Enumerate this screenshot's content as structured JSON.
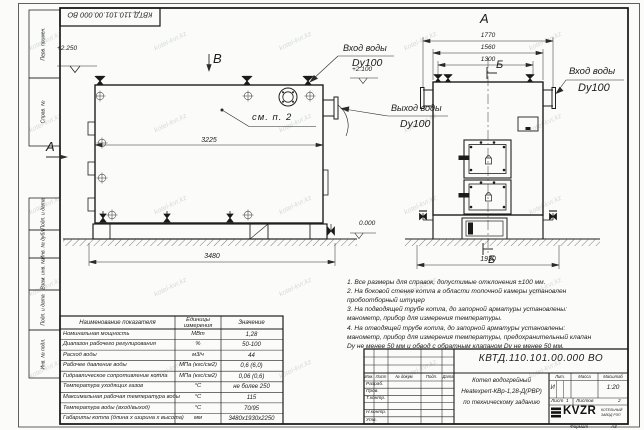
{
  "sheet": {
    "doc_number": "КВТД.110.101.00.000 ВО",
    "format_label": "Формат",
    "format_value": "А3",
    "watermark": "kotel-kvr.kz",
    "margin_labels": [
      "Перв. примен.",
      "Справ. №",
      "Подп. и дата",
      "Инв. № дубл.",
      "Взам. инв. №",
      "Подп. и дата",
      "Инв. № подл."
    ]
  },
  "views": {
    "side": {
      "view_label": "В",
      "arrow_label": "А",
      "dim_top": "3225",
      "dim_base": "3480",
      "elev_top": "+2.250",
      "elev_ground": "0.000",
      "callout": "см. п. 2",
      "inlet_label": "Вход воды",
      "inlet_dn": "Dy100",
      "outlet_label": "Выход воды",
      "outlet_dn": "Dy100"
    },
    "front": {
      "view_title": "А",
      "section_label_top": "Б",
      "section_label_bottom": "Б",
      "dim_flanges": "1770",
      "dim_body": "1560",
      "dim_valves": "1300",
      "dim_base": "1930",
      "elev_top": "+2.100",
      "inlet_label": "Вход воды",
      "inlet_dn": "Dy100"
    }
  },
  "notes": {
    "lines": [
      "1. Все размеры для справок, допустимые отклонения ±100 мм.",
      "2. На боковой стенке котла в области топочной камеры установлен",
      "пробоотборный штуцер",
      "3. На подводящей трубе котла, до запорной арматуры установлены:",
      "манометр, прибор для измерения температуры.",
      "4. На отводящей трубе котла, до запорной арматуры установлены:",
      "манометр, прибор для измерения температуры, предохранительный клапан",
      "Dу не менее 50 мм и обвод с обратным клапаном Dу не менее 50 мм."
    ]
  },
  "spec_table": {
    "headers": [
      "Наименование показателя",
      "Единицы измерения",
      "Значение"
    ],
    "rows": [
      [
        "Номинальная мощность",
        "МВт",
        "1,28"
      ],
      [
        "Диапазон рабочего регулирования",
        "%",
        "50-100"
      ],
      [
        "Расход воды",
        "м3/ч",
        "44"
      ],
      [
        "Рабочее давление воды",
        "МПа (кгс/см2)",
        "0,6 (6,0)"
      ],
      [
        "Гидравлическое сопротивление котла",
        "МПа (кгс/см2)",
        "0,06 (0,6)"
      ],
      [
        "Температура уходящих газов",
        "°С",
        "не более 250"
      ],
      [
        "Максимальная рабочая температура воды",
        "°С",
        "115"
      ],
      [
        "Температура воды (вход/выход)",
        "°С",
        "70/95"
      ],
      [
        "Габариты котла (длина х ширина х высота)",
        "мм",
        "3480х1930х2250"
      ]
    ]
  },
  "title_block": {
    "doc_number": "КВТД.110.101.00.000 ВО",
    "product_line1": "Котел водогрейный",
    "product_line2": "Heatexpert-КВр-1,28-Д(РВР)",
    "product_line3": "по техническому заданию",
    "col_izm": "Изм.",
    "col_list": "Лист",
    "col_doc": "№ докум.",
    "col_podp": "Подп.",
    "col_data": "Дата",
    "row_razrab": "Разраб.",
    "row_prov": "Пров.",
    "row_tkontr": "Т.контр.",
    "row_nkontr": "Н.контр.",
    "row_utv": "Утв.",
    "lit_label": "Лит.",
    "mass_label": "Масса",
    "scale_label": "Масштаб",
    "lit_value": "И",
    "scale_value": "1:20",
    "sheet_label": "Лист",
    "sheet_value": "1",
    "sheets_label": "Листов",
    "sheets_value": "2",
    "logo": "KVZR",
    "logo_sub1": "КОТЕЛЬНЫЙ",
    "logo_sub2": "ЗАВОД РЭП"
  }
}
